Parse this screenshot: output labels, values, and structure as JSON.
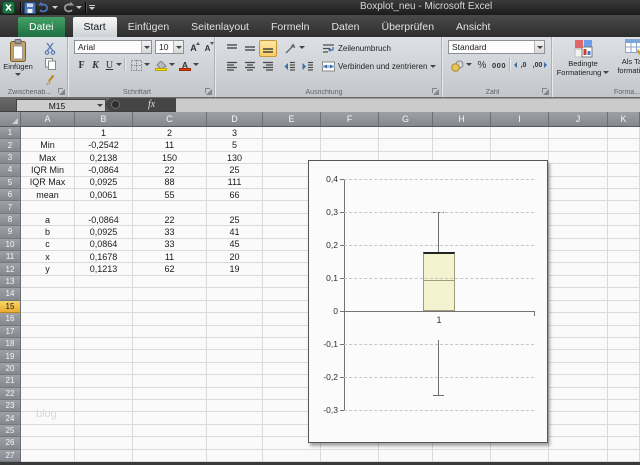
{
  "window": {
    "title": "Boxplot_neu - Microsoft Excel"
  },
  "icons": [
    "excel-logo",
    "save",
    "undo",
    "redo",
    "customize-quick-access",
    "paste-clipboard",
    "scissors",
    "copy",
    "format-painter",
    "grow-font",
    "shrink-font",
    "borders",
    "fill-color",
    "font-color",
    "align-top",
    "align-middle",
    "align-bottom",
    "orientation",
    "align-left",
    "align-center",
    "align-right",
    "decrease-indent",
    "increase-indent",
    "wrap-text",
    "merge-center",
    "currency",
    "increase-decimal",
    "decrease-decimal",
    "conditional-formatting",
    "format-as-table",
    "dialog-launcher",
    "name-box-dropdown",
    "insert-function",
    "select-all"
  ],
  "tabs": [
    {
      "label": "Datei",
      "type": "file",
      "selected": false
    },
    {
      "label": "Start",
      "selected": true
    },
    {
      "label": "Einfügen",
      "selected": false
    },
    {
      "label": "Seitenlayout",
      "selected": false
    },
    {
      "label": "Formeln",
      "selected": false
    },
    {
      "label": "Daten",
      "selected": false
    },
    {
      "label": "Überprüfen",
      "selected": false
    },
    {
      "label": "Ansicht",
      "selected": false
    }
  ],
  "ribbon": {
    "clipboard": {
      "label": "Zwischenab...",
      "paste_label": "Einfügen"
    },
    "font": {
      "label": "Schriftart",
      "family": "Arial",
      "size": "10",
      "bold": "F",
      "italic": "K",
      "underline": "U",
      "grow": "A",
      "shrink": "A"
    },
    "alignment": {
      "label": "Ausrichtung",
      "wrap": "Zeilenumbruch",
      "merge": "Verbinden und zentrieren"
    },
    "number": {
      "label": "Zahl",
      "format": "Standard",
      "percent": "%",
      "thousands": "000",
      "dec_add": ",0",
      "dec_remove": ",00"
    },
    "styles": {
      "label": "Forma...",
      "conditional_1": "Bedingte",
      "conditional_2": "Formatierung",
      "as_table_1": "Als Tab",
      "as_table_2": "formatie..."
    }
  },
  "formula_bar": {
    "name_box": "M15",
    "fx_label": "fx",
    "formula": ""
  },
  "spreadsheet": {
    "columns": [
      "A",
      "B",
      "C",
      "D",
      "E",
      "F",
      "G",
      "H",
      "I",
      "J",
      "K"
    ],
    "col_widths": [
      54,
      58,
      74,
      56,
      58,
      58,
      54,
      58,
      58,
      59,
      0
    ],
    "visible_rows": 28,
    "selected_cell": "M15",
    "selected_row": 15,
    "watermark": "blog",
    "cells": [
      {
        "r": 1,
        "v": [
          "",
          "1",
          "2",
          "3"
        ]
      },
      {
        "r": 2,
        "v": [
          "Min",
          "-0,2542",
          "11",
          "5"
        ]
      },
      {
        "r": 3,
        "v": [
          "Max",
          "0,2138",
          "150",
          "130"
        ]
      },
      {
        "r": 4,
        "v": [
          "IQR Min",
          "-0,0864",
          "22",
          "25"
        ]
      },
      {
        "r": 5,
        "v": [
          "IQR Max",
          "0,0925",
          "88",
          "111"
        ]
      },
      {
        "r": 6,
        "v": [
          "mean",
          "0,0061",
          "55",
          "66"
        ]
      },
      {
        "r": 8,
        "v": [
          "a",
          "-0,0864",
          "22",
          "25"
        ]
      },
      {
        "r": 9,
        "v": [
          "b",
          "0,0925",
          "33",
          "41"
        ]
      },
      {
        "r": 10,
        "v": [
          "c",
          "0,0864",
          "33",
          "45"
        ]
      },
      {
        "r": 11,
        "v": [
          "x",
          "0,1678",
          "11",
          "20"
        ]
      },
      {
        "r": 12,
        "v": [
          "y",
          "0,1213",
          "62",
          "19"
        ]
      }
    ]
  },
  "chart_data": {
    "type": "boxplot",
    "categories": [
      "1"
    ],
    "gridlines": "dashed-horizontal",
    "legend": false,
    "y_axis": {
      "min": -0.3,
      "max": 0.4,
      "step": 0.1,
      "ticks": [
        {
          "label": "0,4",
          "value": 0.4
        },
        {
          "label": "0,3",
          "value": 0.3
        },
        {
          "label": "0,2",
          "value": 0.2
        },
        {
          "label": "0,1",
          "value": 0.1
        },
        {
          "label": "0",
          "value": 0
        },
        {
          "label": "-0,1",
          "value": -0.1
        },
        {
          "label": "-0,2",
          "value": -0.2
        },
        {
          "label": "-0,3",
          "value": -0.3
        }
      ]
    },
    "series": [
      {
        "category": "1",
        "box_bottom": 0,
        "median": 0.0925,
        "box_top": 0.1789,
        "whisker_high": 0.3002,
        "whisker_low_start": -0.0864,
        "whisker_low_end": -0.2542
      }
    ]
  },
  "colors": {
    "datei_green": "#1e6e41",
    "selection_yellow": "#e9ad32",
    "ribbon_highlight": "#fbce62",
    "box_fill": "#f3f3cf"
  }
}
